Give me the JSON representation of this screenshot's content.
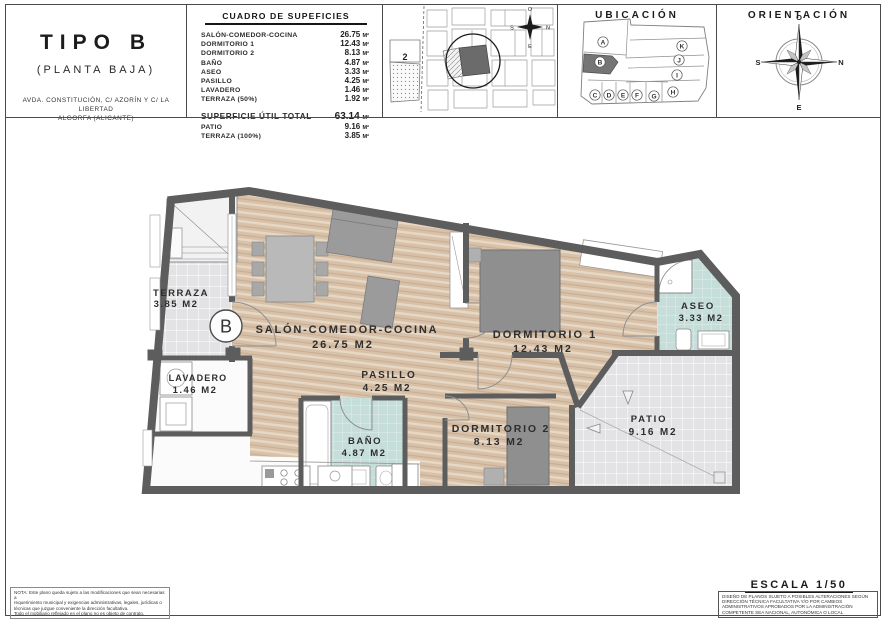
{
  "title_block": {
    "type_label": "TIPO B",
    "floor_label": "(PLANTA BAJA)",
    "address_line1": "AVDA. CONSTITUCIÓN, C/ AZORÍN Y C/ LA LIBERTAD",
    "address_line2": "ALGORFA (ALICANTE)"
  },
  "surfaces_table": {
    "title": "CUADRO DE SUPEFICIES",
    "unit": "M²",
    "rows": [
      {
        "label": "SALÓN-COMEDOR-COCINA",
        "value": "26.75"
      },
      {
        "label": "DORMITORIO 1",
        "value": "12.43"
      },
      {
        "label": "DORMITORIO 2",
        "value": "8.13"
      },
      {
        "label": "BAÑO",
        "value": "4.87"
      },
      {
        "label": "ASEO",
        "value": "3.33"
      },
      {
        "label": "PASILLO",
        "value": "4.25"
      },
      {
        "label": "LAVADERO",
        "value": "1.46"
      },
      {
        "label": "TERRAZA (50%)",
        "value": "1.92"
      }
    ],
    "total": {
      "label": "SUPERFICIE ÚTIL TOTAL",
      "value": "63.14"
    },
    "extra_rows": [
      {
        "label": "PATIO",
        "value": "9.16"
      },
      {
        "label": "TERRAZA (100%)",
        "value": "3.85"
      }
    ]
  },
  "site_map": {
    "parcel_label": "2",
    "compass": {
      "top": "O",
      "right": "N",
      "bottom": "E",
      "left": "S"
    }
  },
  "ubicacion": {
    "title": "UBICACIÓN",
    "highlighted_unit": "B",
    "units": [
      "A",
      "B",
      "C",
      "D",
      "E",
      "F",
      "G",
      "H",
      "I",
      "J",
      "K"
    ]
  },
  "orientacion": {
    "title": "ORIENTACIÓN",
    "compass": {
      "top": "O",
      "right": "N",
      "bottom": "E",
      "left": "S"
    }
  },
  "floor_plan": {
    "unit_label": "B",
    "rooms": [
      {
        "name": "TERRAZA",
        "area": "3.85 M2"
      },
      {
        "name": "SALÓN-COMEDOR-COCINA",
        "area": "26.75 M2"
      },
      {
        "name": "DORMITORIO 1",
        "area": "12.43 M2"
      },
      {
        "name": "ASEO",
        "area": "3.33 M2"
      },
      {
        "name": "LAVADERO",
        "area": "1.46 M2"
      },
      {
        "name": "PASILLO",
        "area": "4.25 M2"
      },
      {
        "name": "BAÑO",
        "area": "4.87 M2"
      },
      {
        "name": "DORMITORIO 2",
        "area": "8.13 M2"
      },
      {
        "name": "PATIO",
        "area": "9.16 M2"
      }
    ]
  },
  "notes": {
    "left_note_lines": [
      "NOTA: Este plano queda sujeto a las modificaciones que sean necesarias a",
      "requerimiento municipal y exigencias administrativas, legales, jurídicas o",
      "técnicas que juzgue conveniente la dirección facultativa.",
      "Todo el mobiliario reflejado en el plano no es objeto de contrato."
    ],
    "scale_label": "ESCALA 1/50",
    "right_note_lines": [
      "DISEÑO DE PLANOS SUJETO A POSIBLES ALTERACIONES SEGÚN",
      "DIRECCIÓN TÉCNICA FACULTATIVA Y/O POR CAMBIOS",
      "ADMINISTRATIVOS APROBADOS POR LA ADMINISTRACIÓN",
      "COMPETENTE SEA NACIONAL, AUTONÓMICA O LOCAL"
    ]
  },
  "colors": {
    "wall": "#5d5d5d",
    "wood_floor": "#d8c1a9",
    "wet_room_floor": "#c6ded9",
    "tile_floor": "#e3e3e5",
    "furniture": "#9b9b9b",
    "highlighted_unit": "#757575"
  }
}
